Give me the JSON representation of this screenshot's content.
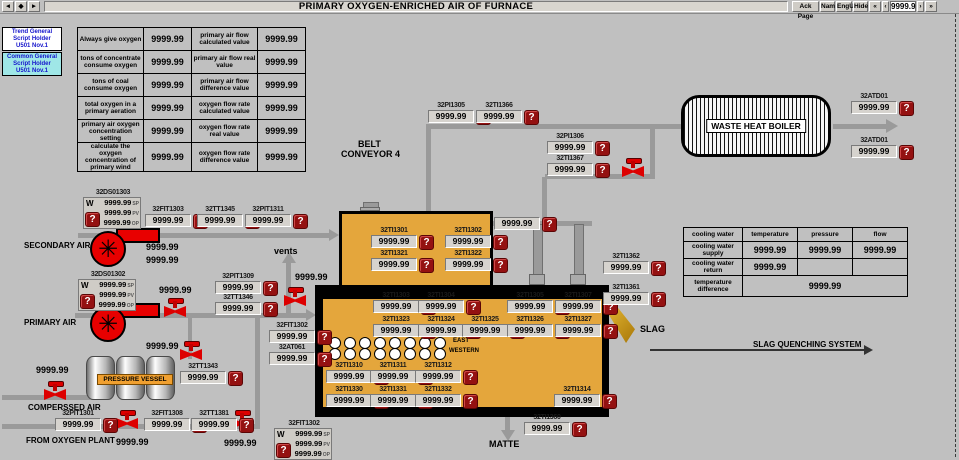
{
  "titlebar": {
    "nav": [
      "◄",
      "◆",
      "►"
    ],
    "title": "PRIMARY OXYGEN-ENRICHED AIR OF FURNACE",
    "buttons": [
      "Ack Page",
      "Nam",
      "EngU",
      "Hide"
    ],
    "pager_first": "«",
    "pager_prev": "‹",
    "pager_value": "9999.9",
    "pager_next": "›",
    "pager_last": "»"
  },
  "script_holders": [
    {
      "line1": "Trend General",
      "line2": "Script Holder",
      "line3": "U501 Nov.1"
    },
    {
      "line1": "Common General",
      "line2": "Script Holder",
      "line3": "U501 Nov.1"
    }
  ],
  "oxygen_table": {
    "rows": [
      [
        "Always give oxygen",
        "9999.99",
        "primary air flow calculated value",
        "9999.99"
      ],
      [
        "tons of concentrate consume oxygen",
        "9999.99",
        "primary air flow real value",
        "9999.99"
      ],
      [
        "tons of coal consume oxygen",
        "9999.99",
        "primary air flow difference value",
        "9999.99"
      ],
      [
        "total oxygen in a primary aeration",
        "9999.99",
        "oxygen flow rate calculated value",
        "9999.99"
      ],
      [
        "primary air oxygen concentration setting",
        "9999.99",
        "oxygen flow rate real value",
        "9999.99"
      ],
      [
        "calculate the oxygen concentration of primary wind",
        "9999.99",
        "oxygen flow rate difference value",
        "9999.99"
      ]
    ]
  },
  "cooling_table": {
    "headers": [
      "cooling water",
      "temperature",
      "pressure",
      "flow"
    ],
    "rows": [
      [
        "cooling water supply",
        "9999.99",
        "9999.99",
        "9999.99"
      ],
      [
        "cooling water return",
        "9999.99",
        "",
        ""
      ],
      [
        "temperature difference",
        "9999.99"
      ]
    ]
  },
  "labels": {
    "secondary_air": "SECONDARY AIR",
    "primary_air": "PRIMARY AIR",
    "vents": "vents",
    "belt_line1": "BELT",
    "belt_line2": "CONVEYOR 4",
    "compressed_air": "COMPERSSED AIR",
    "from_oxygen_plant": "FROM OXYGEN PLANT",
    "pressure_vessel": "PRESSURE VESSEL",
    "waste_heat_boiler": "WASTE HEAT BOILER",
    "slag": "SLAG",
    "slag_quenching": "SLAG QUENCHING SYSTEM",
    "matte": "MATTE",
    "east": "EAST",
    "western": "WESTERN"
  },
  "alarm": {
    "glyph": "?"
  },
  "instruments": {
    "pi1305": {
      "tag": "32PI1305",
      "value": "9999.99"
    },
    "ti1366": {
      "tag": "32TI1366",
      "value": "9999.99"
    },
    "pi1306": {
      "tag": "32PI1306",
      "value": "9999.99"
    },
    "ti1367": {
      "tag": "32TI1367",
      "value": "9999.99"
    },
    "atd01a": {
      "tag": "32ATD01",
      "value": "9999.99"
    },
    "atd01b": {
      "tag": "32ATD01",
      "value": "9999.99"
    },
    "unk1": {
      "tag": "",
      "value": "9999.99"
    },
    "fit1303": {
      "tag": "32FIT1303",
      "value": "9999.99"
    },
    "tt1345": {
      "tag": "32TT1345",
      "value": "9999.99"
    },
    "pit1311": {
      "tag": "32PIT1311",
      "value": "9999.99"
    },
    "pit1309": {
      "tag": "32PIT1309",
      "value": "9999.99"
    },
    "tt1346": {
      "tag": "32TT1346",
      "value": "9999.99"
    },
    "fit1302i": {
      "tag": "32FIT1302",
      "value": "9999.99"
    },
    "at061": {
      "tag": "32AT061",
      "value": "9999.99"
    },
    "tt1343": {
      "tag": "32TT1343",
      "value": "9999.99"
    },
    "pit1301": {
      "tag": "32PIT1301",
      "value": "9999.99"
    },
    "fit1308": {
      "tag": "32FIT1308",
      "value": "9999.99"
    },
    "tt1381": {
      "tag": "32TT1381",
      "value": "9999.99"
    },
    "ti1301": {
      "tag": "32TI1301",
      "value": "9999.99"
    },
    "ti1302": {
      "tag": "32TI1302",
      "value": "9999.99"
    },
    "ti1321": {
      "tag": "32TI1321",
      "value": "9999.99"
    },
    "ti1322": {
      "tag": "32TI1322",
      "value": "9999.99"
    },
    "ti1303": {
      "tag": "32TI1303",
      "value": "9999.99"
    },
    "ti1304": {
      "tag": "32TI1304",
      "value": "9999.99"
    },
    "ti1305f": {
      "tag": "32TI1305",
      "value": "9999.99"
    },
    "ti1307": {
      "tag": "32TI1307",
      "value": "9999.99"
    },
    "ti1323": {
      "tag": "32TI1323",
      "value": "9999.99"
    },
    "ti1324": {
      "tag": "32TI1324",
      "value": "9999.99"
    },
    "ti1325": {
      "tag": "32TI1325",
      "value": "9999.99"
    },
    "ti1326": {
      "tag": "32TI1326",
      "value": "9999.99"
    },
    "ti1327": {
      "tag": "32TI1327",
      "value": "9999.99"
    },
    "ti1310": {
      "tag": "32TI1310",
      "value": "9999.99"
    },
    "ti1311": {
      "tag": "32TI1311",
      "value": "9999.99"
    },
    "ti1312": {
      "tag": "32TI1312",
      "value": "9999.99"
    },
    "ti1330": {
      "tag": "32TI1330",
      "value": "9999.99"
    },
    "ti1331": {
      "tag": "32TI1331",
      "value": "9999.99"
    },
    "ti1332": {
      "tag": "32TI1332",
      "value": "9999.99"
    },
    "ti1314": {
      "tag": "32TI1314",
      "value": "9999.99"
    },
    "ti1360": {
      "tag": "32TI1360",
      "value": "9999.99"
    },
    "ti1362": {
      "tag": "32TI1362",
      "value": "9999.99"
    },
    "ti1361": {
      "tag": "32TI1361",
      "value": "9999.99"
    }
  },
  "controllers": {
    "ds01303": {
      "tag": "32DS01303",
      "mode": "W",
      "rows": [
        [
          "9999.99",
          "SP"
        ],
        [
          "9999.99",
          "PV"
        ],
        [
          "9999.99",
          "OP"
        ]
      ]
    },
    "ds01302": {
      "tag": "32DS01302",
      "mode": "W",
      "rows": [
        [
          "9999.99",
          "SP"
        ],
        [
          "9999.99",
          "PV"
        ],
        [
          "9999.99",
          "OP"
        ]
      ]
    },
    "fit1302c": {
      "tag": "32FIT1302",
      "mode": "W",
      "rows": [
        [
          "9999.99",
          "SP"
        ],
        [
          "9999.99",
          "PV"
        ],
        [
          "9999.99",
          "OP"
        ]
      ]
    }
  },
  "values": {
    "v_sec1": "9999.99",
    "v_sec2": "9999.99",
    "v_prim_valve": "9999.99",
    "v_vent": "9999.99",
    "v_tank_valve": "9999.99",
    "v_left": "9999.99",
    "v_oxy1": "9999.99",
    "v_oxy2": "9999.99"
  },
  "colors": {
    "background": "#C0C0C0",
    "furnace": "#E4A63C",
    "alarm_red": "#941111",
    "equipment_red": "#E80000",
    "pipe_gray": "#9A9A9A",
    "slag_gold": "#D8A019",
    "holder_text_blue": "#1515CC",
    "holder2_bg": "#9FE7E7",
    "pressure_vessel_label_bg": "#F0A030"
  }
}
